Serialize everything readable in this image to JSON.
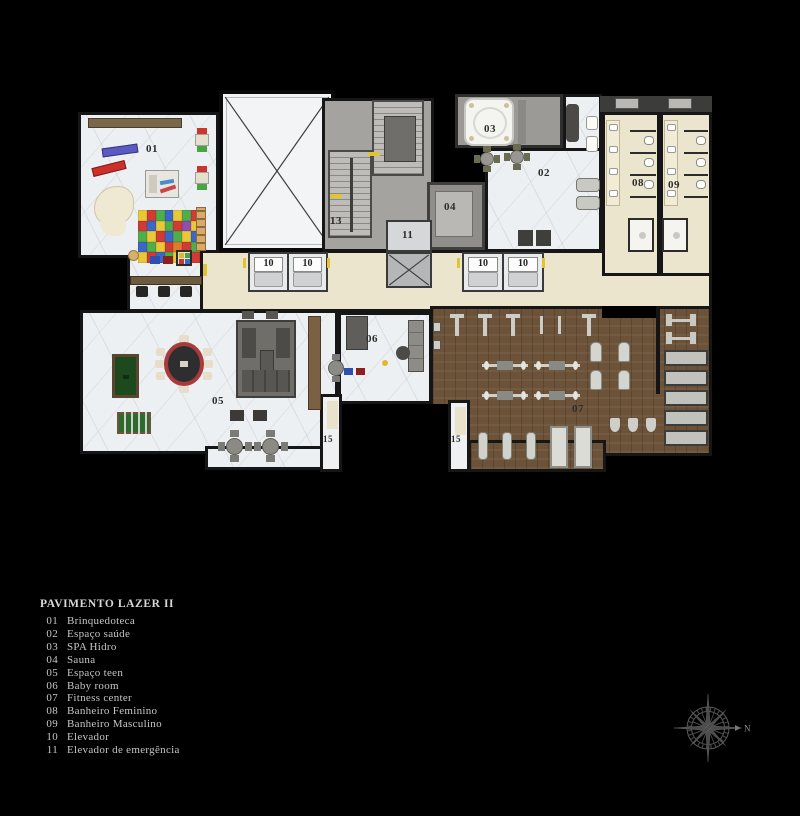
{
  "legend": {
    "title": "PAVIMENTO LAZER II",
    "items": [
      {
        "num": "01",
        "label": "Brinquedoteca"
      },
      {
        "num": "02",
        "label": "Espaço saúde"
      },
      {
        "num": "03",
        "label": "SPA Hidro"
      },
      {
        "num": "04",
        "label": "Sauna"
      },
      {
        "num": "05",
        "label": "Espaço teen"
      },
      {
        "num": "06",
        "label": "Baby room"
      },
      {
        "num": "07",
        "label": "Fitness center"
      },
      {
        "num": "08",
        "label": "Banheiro Feminino"
      },
      {
        "num": "09",
        "label": "Banheiro Masculino"
      },
      {
        "num": "10",
        "label": "Elevador"
      },
      {
        "num": "11",
        "label": "Elevador de emergência"
      }
    ]
  },
  "plan": {
    "labels": {
      "r01": "01",
      "r02": "02",
      "r03": "03",
      "r04": "04",
      "r05": "05",
      "r06": "06",
      "r07": "07",
      "r08": "08",
      "r09": "09",
      "r10": "10",
      "r11": "11",
      "r13": "13",
      "r15": "15"
    }
  },
  "compass": {
    "north_label": "N"
  },
  "palette": {
    "background": "#000000",
    "marble": "#edf0f2",
    "corridor": "#ebe5cd",
    "wood_floor": "#6b5238",
    "gray_zone": "#a4a39f",
    "wall": "#161616",
    "accent_yellow": "#e0c531",
    "legend_text": "#c6c6c6"
  },
  "rug": {
    "rows": [
      [
        "#e8c836",
        "#d23b35",
        "#4fae49",
        "#3b67c8",
        "#e8c836",
        "#4fae49",
        "#d23b35"
      ],
      [
        "#d23b35",
        "#3b67c8",
        "#e8c836",
        "#4fae49",
        "#d23b35",
        "#8e4fb0",
        "#e8c836"
      ],
      [
        "#4fae49",
        "#e8c836",
        "#d23b35",
        "#3b67c8",
        "#4fae49",
        "#e8c836",
        "#3b67c8"
      ],
      [
        "#3b67c8",
        "#4fae49",
        "#e8c836",
        "#d23b35",
        "#e07a2e",
        "#d23b35",
        "#4fae49"
      ],
      [
        "#e8c836",
        "#d23b35",
        "#3b67c8",
        "#4fae49",
        "#e8c836",
        "#4fae49",
        "#d23b35"
      ]
    ]
  }
}
